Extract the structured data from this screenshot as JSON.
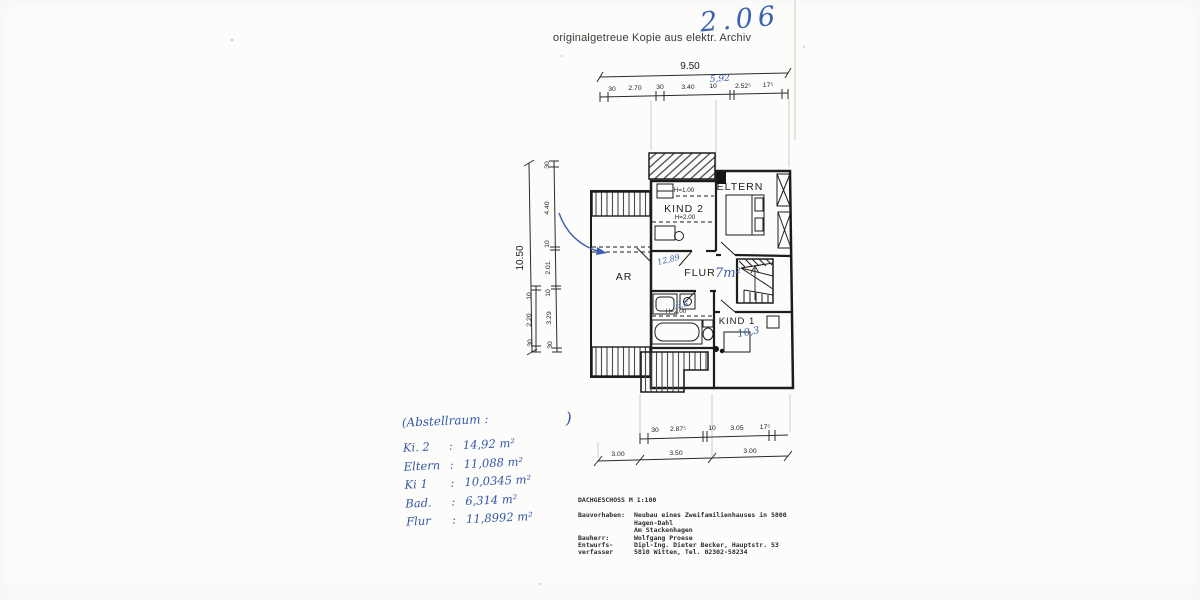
{
  "page": {
    "archive_note": "originalgetreue Kopie aus elektr. Archiv",
    "page_number": "2.06"
  },
  "dims": {
    "top_total": "9.50",
    "top_segments": [
      "30",
      "2.70",
      "30",
      "3.40",
      "10",
      "2.52⁵",
      "17⁵"
    ],
    "top_handwritten": "5,92",
    "left_total": "10.50",
    "left_main": [
      "30",
      "4.40",
      "10",
      "2.01",
      "10",
      "3.29",
      "30"
    ],
    "left_inner": [
      "10",
      "2.20",
      "30"
    ],
    "bottom_row1": [
      "30",
      "2.87⁵",
      "10",
      "3.05",
      "17⁵"
    ],
    "bottom_row2": [
      "3.00",
      "3.50",
      "3.00"
    ]
  },
  "plan": {
    "labels": {
      "kind2": "KIND 2",
      "eltern": "ELTERN",
      "ar": "AR",
      "flur": "FLUR",
      "kind1": "KIND 1"
    },
    "heights": {
      "h100": "H=1.00",
      "h200_kind2": "H=2.00",
      "h200_bad": "H=2.00"
    },
    "handwritten": {
      "flur_calc": "12,89",
      "flur_area": "7m²",
      "bad_area": "6,6",
      "kind1_area": "10,3"
    },
    "ink_color": "#3b5fae",
    "line_color": "#1d1d1b"
  },
  "notes": {
    "heading_open": "(Abstellraum :",
    "heading_close": ")",
    "rows": [
      {
        "label": "Ki. 2",
        "value": "14,92 m²"
      },
      {
        "label": "Eltern",
        "value": "11,088 m²"
      },
      {
        "label": "Ki 1",
        "value": "10,0345 m²"
      },
      {
        "label": "Bad.",
        "value": "6,314 m²"
      },
      {
        "label": "Flur",
        "value": "11,8992 m²"
      }
    ]
  },
  "titleblock": {
    "title": "DACHGESCHOSS M 1:100",
    "rows": [
      {
        "label": "Bauvorhaben:",
        "text": "Neubau eines Zweifamilienhauses in 5800 Hagen-Dahl"
      },
      {
        "label": "",
        "text": "Am Stackenhagen"
      },
      {
        "label": "Bauherr:",
        "text": "Wolfgang Proese"
      },
      {
        "label": "Entwurfs-",
        "text": "Dipl-Ing. Dieter Becker, Hauptstr. 53"
      },
      {
        "label": "verfasser",
        "text": "5810 Witten, Tel. 02302-58234"
      }
    ]
  }
}
